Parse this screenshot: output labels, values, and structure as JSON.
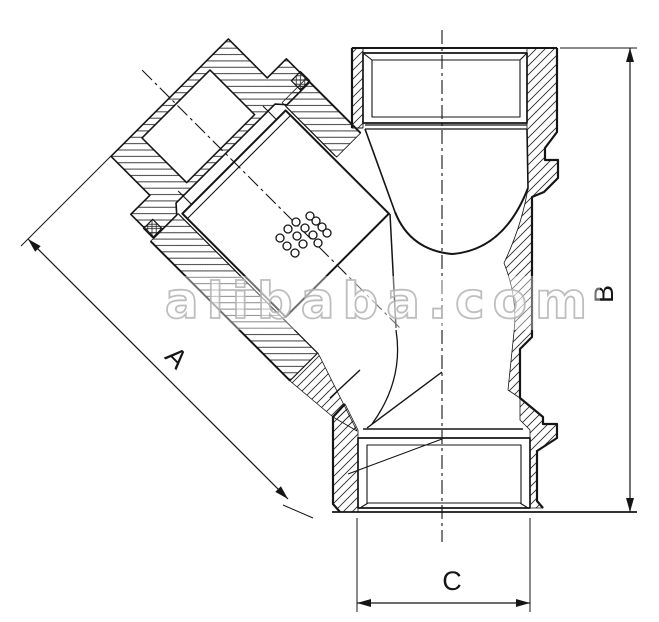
{
  "page": {
    "background": "#ffffff"
  },
  "drawing": {
    "kind": "technical section drawing",
    "subject": "Y-strainer valve cross-section",
    "line_color": "#151515",
    "labels": {
      "dim_a": "A",
      "dim_b": "B",
      "dim_c": "C"
    }
  },
  "watermark": {
    "text": "alibaba.com",
    "color": "#b9b9b9"
  }
}
